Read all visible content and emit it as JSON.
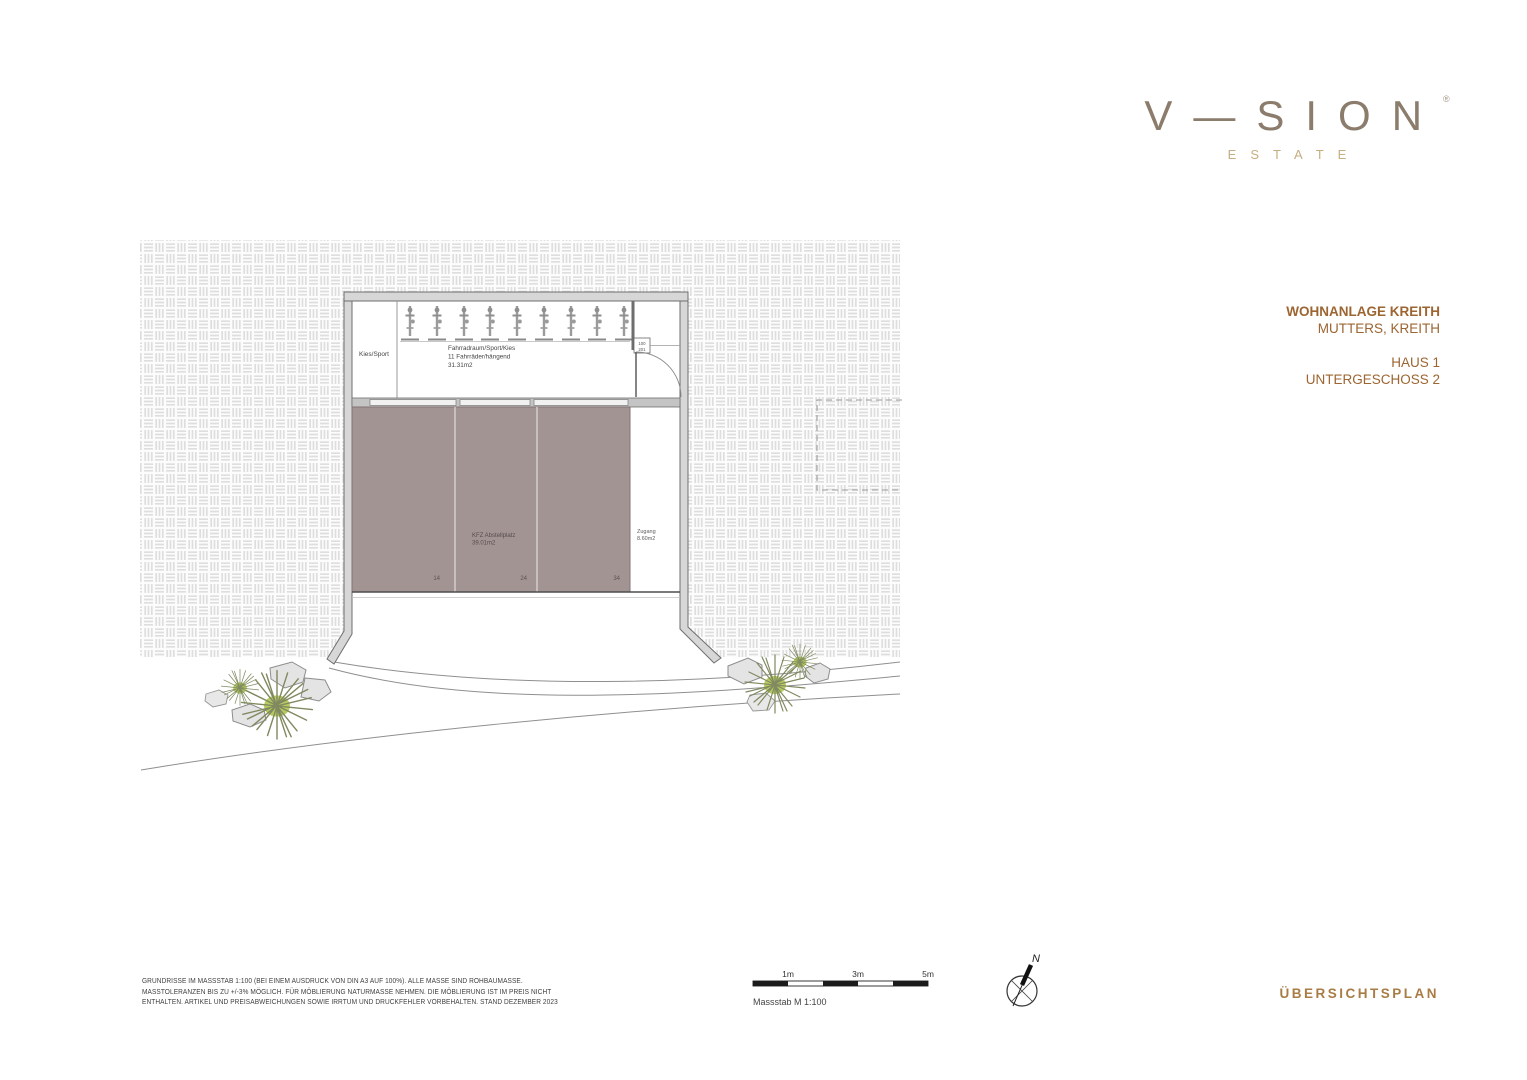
{
  "logo": {
    "wordmark": "V—SION",
    "estate": "ESTATE",
    "registered": "®"
  },
  "project": {
    "title": "WOHNANLAGE KREITH",
    "location": "MUTTERS, KREITH",
    "house": "HAUS 1",
    "floor": "UNTERGESCHOSS 2"
  },
  "plan": {
    "outdoor_label": "Kies/Sport",
    "bike_room": {
      "name": "Fahrradraum/Sport/Kies",
      "capacity": "11 Fahrräder/hängend",
      "area": "31.31m2"
    },
    "door_tag": {
      "top": "100",
      "bottom": "201"
    },
    "parking": {
      "label": "KFZ Abstellplatz",
      "area": "39.01m2",
      "space_numbers": [
        "14",
        "24",
        "34"
      ]
    },
    "access": {
      "label": "Zugang",
      "area": "8.60m2"
    }
  },
  "footer": {
    "disclaimer_lines": [
      "GRUNDRISSE IM MASSSTAB 1:100 (BEI EINEM AUSDRUCK VON DIN A3 AUF 100%). ALLE MASSE SIND ROHBAUMASSE.",
      "MASSTOLERANZEN BIS ZU +/-3% MÖGLICH. FÜR MÖBLIERUNG NATURMASSE NEHMEN. DIE MÖBLIERUNG IST IM PREIS NICHT",
      "ENTHALTEN. ARTIKEL UND PREISABWEICHUNGEN SOWIE IRRTUM UND DRUCKFEHLER VORBEHALTEN. STAND DEZEMBER 2023"
    ],
    "scale": {
      "labels": [
        "1m",
        "3m",
        "5m"
      ],
      "caption": "Massstab M 1:100"
    },
    "compass_north": "N",
    "plan_type": "ÜBERSICHTSPLAN"
  },
  "colors": {
    "accent_brown": "#9c6531",
    "logo_gray": "#8b7c6c",
    "estate_gold": "#c6ad82",
    "parking_mauve": "#a39494",
    "plant_green": "#b7ca5f"
  }
}
